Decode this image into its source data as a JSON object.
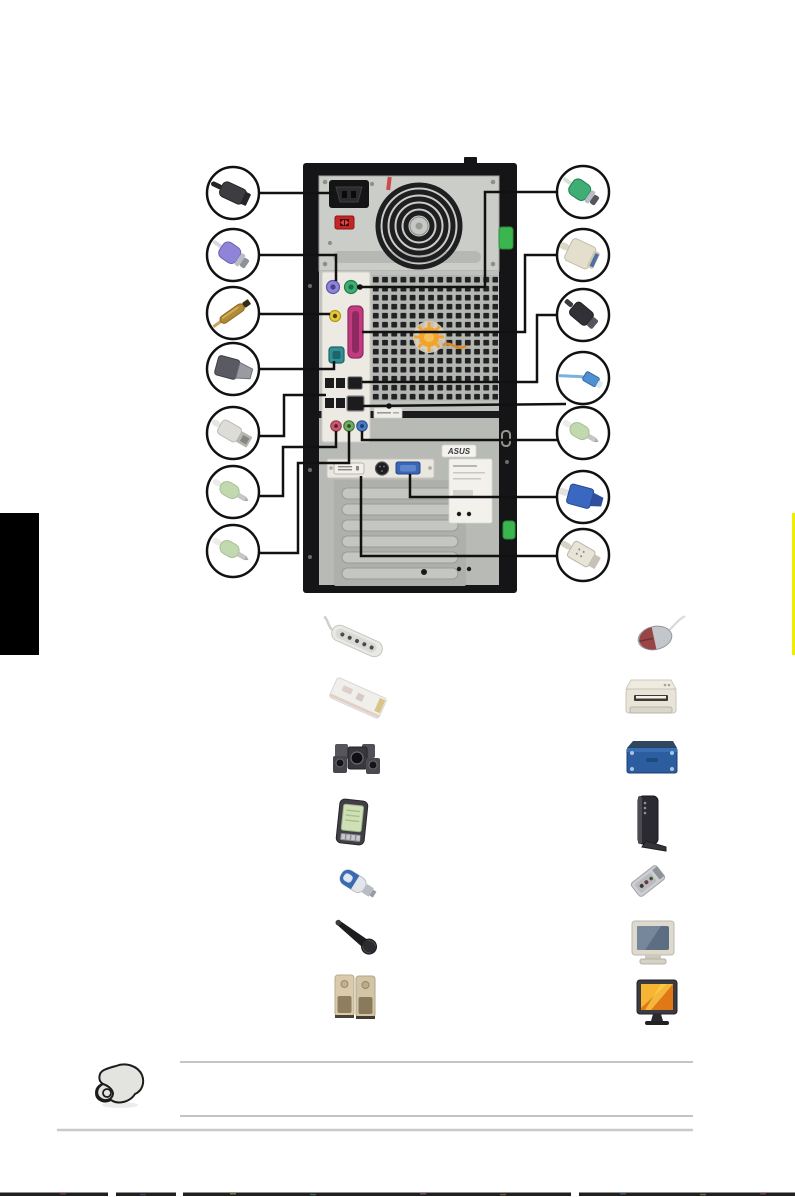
{
  "page": {
    "kind": "manual-page-rear-panel-connection-diagram",
    "background": "#ffffff",
    "width": 795,
    "height": 1197
  },
  "chapter_tab": {
    "left_color": "#000000",
    "right_edge_color": "#f3eb00"
  },
  "tower": {
    "asus_sticker_text": "ASUS",
    "chassis_color": "#151517",
    "psu_panel_color": "#cbcdc9",
    "body_color": "#bfc1bd",
    "clip_color": "#3bb54d",
    "celeron_sticker_color": "#f0a42c",
    "port_colors": {
      "ps2_keyboard": "#8f84d8",
      "ps2_mouse": "#3fae74",
      "spdif_out": "#e6c838",
      "parallel": "#c23a80",
      "serial": "#2f8f92",
      "usb": "#1c1c1e",
      "ieee1394": "#1c1c1e",
      "lan": "#1c1c1e",
      "mic_in": "#c85a70",
      "line_out": "#6fae62",
      "line_in": "#4a7ac8",
      "vga": "#3a66b8",
      "dvi": "#f2f0e8",
      "s_video": "#1c1c1e",
      "power_inlet": "#141414",
      "voltage_switch": "#c52525"
    }
  },
  "callouts": {
    "left": [
      {
        "id": "power-cord",
        "connects_to": "power-inlet"
      },
      {
        "id": "ps2-keyboard-connector",
        "connects_to": "ps2-keyboard-port"
      },
      {
        "id": "spdif-cable",
        "connects_to": "spdif-out-port"
      },
      {
        "id": "serial-connector",
        "connects_to": "serial-port"
      },
      {
        "id": "usb-connector",
        "connects_to": "usb-ports"
      },
      {
        "id": "audio-plug-microphone",
        "connects_to": "microphone-port"
      },
      {
        "id": "audio-plug-line-out",
        "connects_to": "line-out-port"
      }
    ],
    "right": [
      {
        "id": "ps2-mouse-connector",
        "connects_to": "ps2-mouse-port"
      },
      {
        "id": "parallel-connector",
        "connects_to": "parallel-port"
      },
      {
        "id": "ieee1394-connector",
        "connects_to": "ieee1394-port"
      },
      {
        "id": "lan-cable",
        "connects_to": "lan-port"
      },
      {
        "id": "audio-plug-line-in",
        "connects_to": "line-in-port"
      },
      {
        "id": "vga-connector",
        "connects_to": "vga-port"
      },
      {
        "id": "dvi-connector",
        "connects_to": "dvi-port"
      }
    ]
  },
  "peripherals": {
    "left": [
      "power-strip",
      "modem-riser-card",
      "multimedia-speaker-system",
      "pda",
      "usb-flash-drive",
      "microphone",
      "stereo-speakers"
    ],
    "right": [
      "mouse",
      "printer",
      "external-drive",
      "external-modem",
      "portable-audio-device",
      "crt-monitor",
      "lcd-monitor"
    ]
  },
  "note": {
    "icon": "pointing-hand-icon",
    "ruled_line_count": 2
  }
}
